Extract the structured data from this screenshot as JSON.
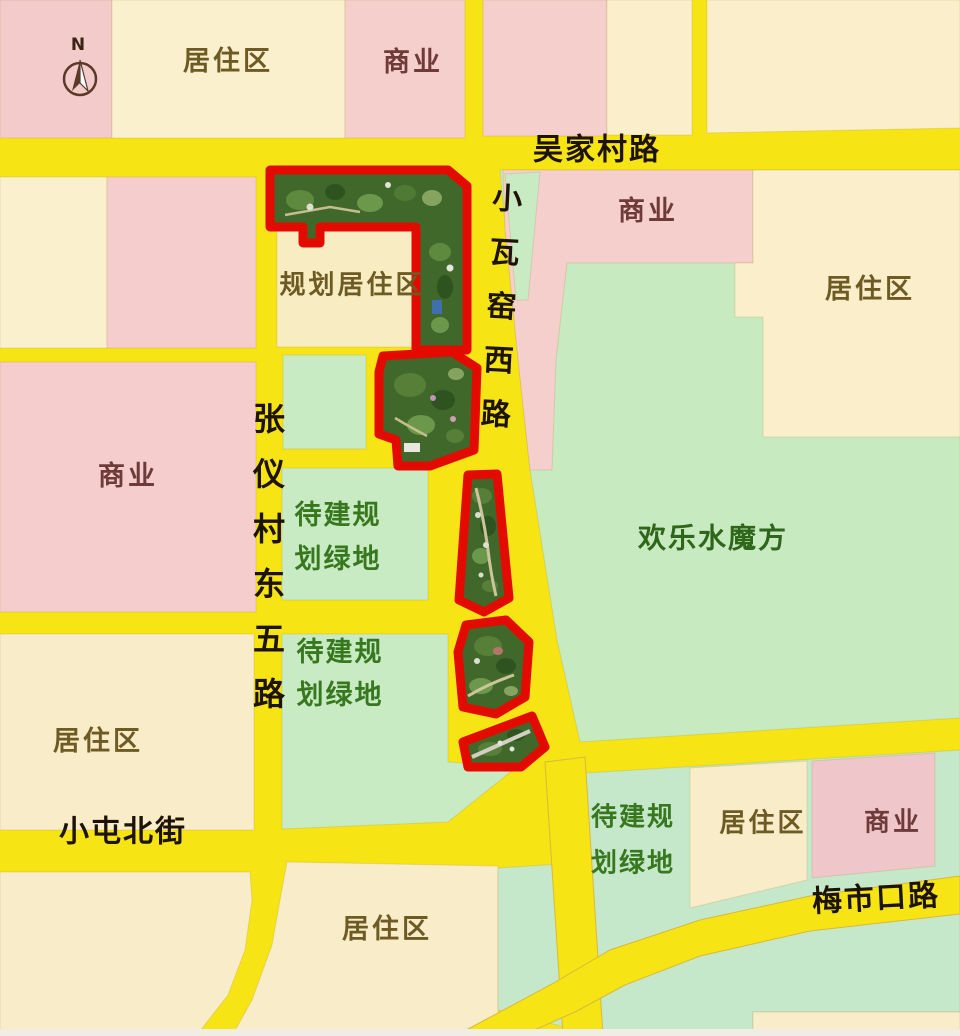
{
  "map": {
    "compass": {
      "north_label": "N"
    },
    "roads": {
      "wujiacun_road": "吴家村路",
      "xiaowayao_west_road": "小瓦窑西路",
      "zhangyicun_east_5th_road": "张仪村东五路",
      "xiaotun_north_street": "小屯北街",
      "meishikou_road": "梅市口路"
    },
    "zones": {
      "residential": "居住区",
      "commercial": "商业",
      "planned_residential": "规划居住区",
      "planned_green_line1": "待建规",
      "planned_green_line2": "划绿地",
      "water_magic_cube": "欢乐水魔方"
    },
    "parks": {
      "count": 5,
      "outline_color": "#E30B00"
    },
    "colors": {
      "road_yellow": "#F7E414",
      "block_pink": "#F5CFCC",
      "block_cream": "#F9EEC9",
      "block_green": "#C9EBC4",
      "park_fill": "#41682B"
    }
  }
}
